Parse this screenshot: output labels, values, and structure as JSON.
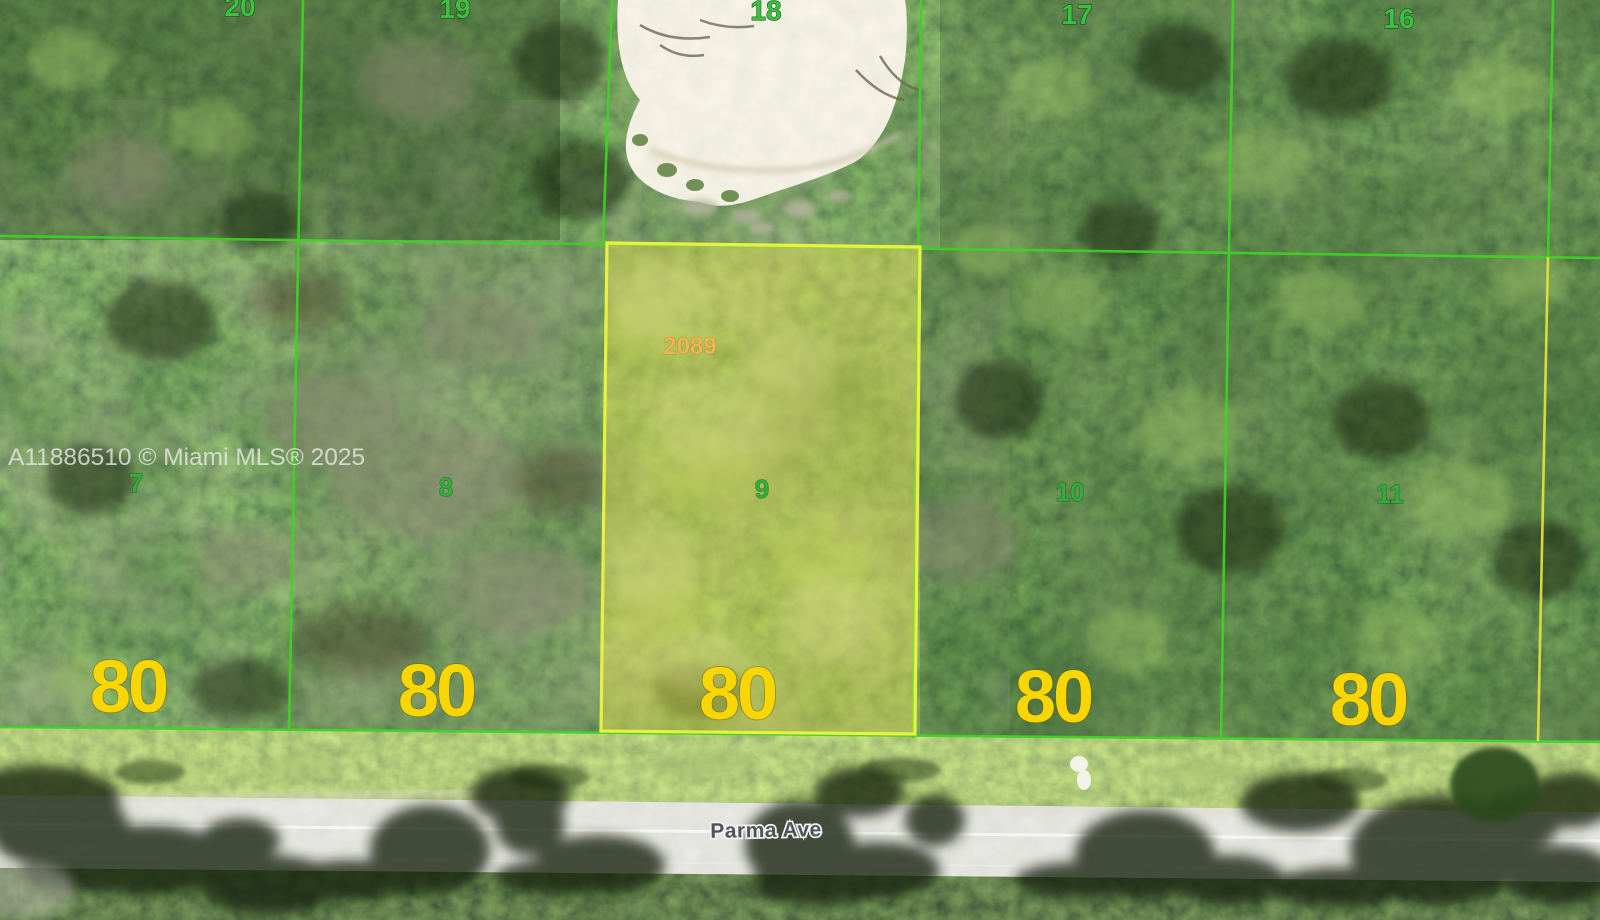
{
  "map": {
    "watermark": "A11886510 © Miami MLS® 2025",
    "street": "Parma Ave",
    "top_lot_numbers": [
      "20",
      "19",
      "18",
      "17",
      "16"
    ],
    "bottom_lots": [
      {
        "lot": "7",
        "frontage": "80"
      },
      {
        "lot": "8",
        "frontage": "80"
      },
      {
        "lot": "9",
        "frontage": "80"
      },
      {
        "lot": "10",
        "frontage": "80"
      },
      {
        "lot": "11",
        "frontage": "80"
      }
    ],
    "highlighted_parcel": {
      "parcel_number": "2089",
      "lot": "9",
      "frontage": "80"
    },
    "colors": {
      "lot_line_green": "#3fd226",
      "highlight_yellow": "#eaf041",
      "dimension_text_yellow": "#f7d603",
      "lot_number_green": "#2fae3c",
      "top_lot_number_green": "#3bc142",
      "parcel_number_orange": "#f1b44e",
      "road_gray": "#c6c5c0",
      "sand_clearing": "#ece7da"
    }
  }
}
